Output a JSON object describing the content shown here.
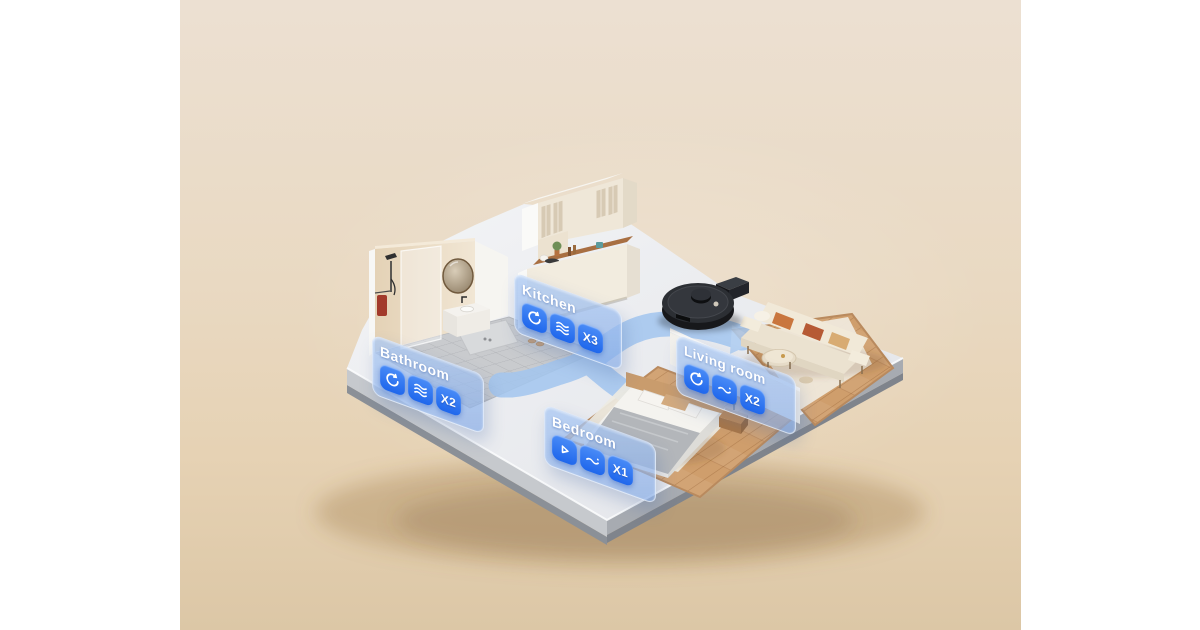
{
  "rooms": [
    {
      "id": "bathroom",
      "name": "Bathroom",
      "icons": [
        "spin",
        "waves"
      ],
      "count": "X2"
    },
    {
      "id": "kitchen",
      "name": "Kitchen",
      "icons": [
        "spin",
        "waves"
      ],
      "count": "X3"
    },
    {
      "id": "living-room",
      "name": "Living room",
      "icons": [
        "spin",
        "wave"
      ],
      "count": "X2"
    },
    {
      "id": "bedroom",
      "name": "Bedroom",
      "icons": [
        "triangle",
        "wave"
      ],
      "count": "X1"
    }
  ],
  "objects": {
    "robot": "robot vacuum cleaner",
    "dock": "charging dock",
    "path": "cleaning route with arrow"
  },
  "colors": {
    "background_top": "#ece0d2",
    "background_bottom": "#dcc7a6",
    "side_bars": "#ffffff",
    "platform_top": "#eef0f3",
    "platform_side": "#a7abb1",
    "tile_floor": "#c9cbce",
    "wood_floor": "#cf9e6c",
    "path_blue": "#a3c6ef",
    "panel_blue": "#86aee6",
    "badge_blue": "#2d79f3",
    "robot_black": "#26282d",
    "accent_pillow": "#c9763e"
  }
}
